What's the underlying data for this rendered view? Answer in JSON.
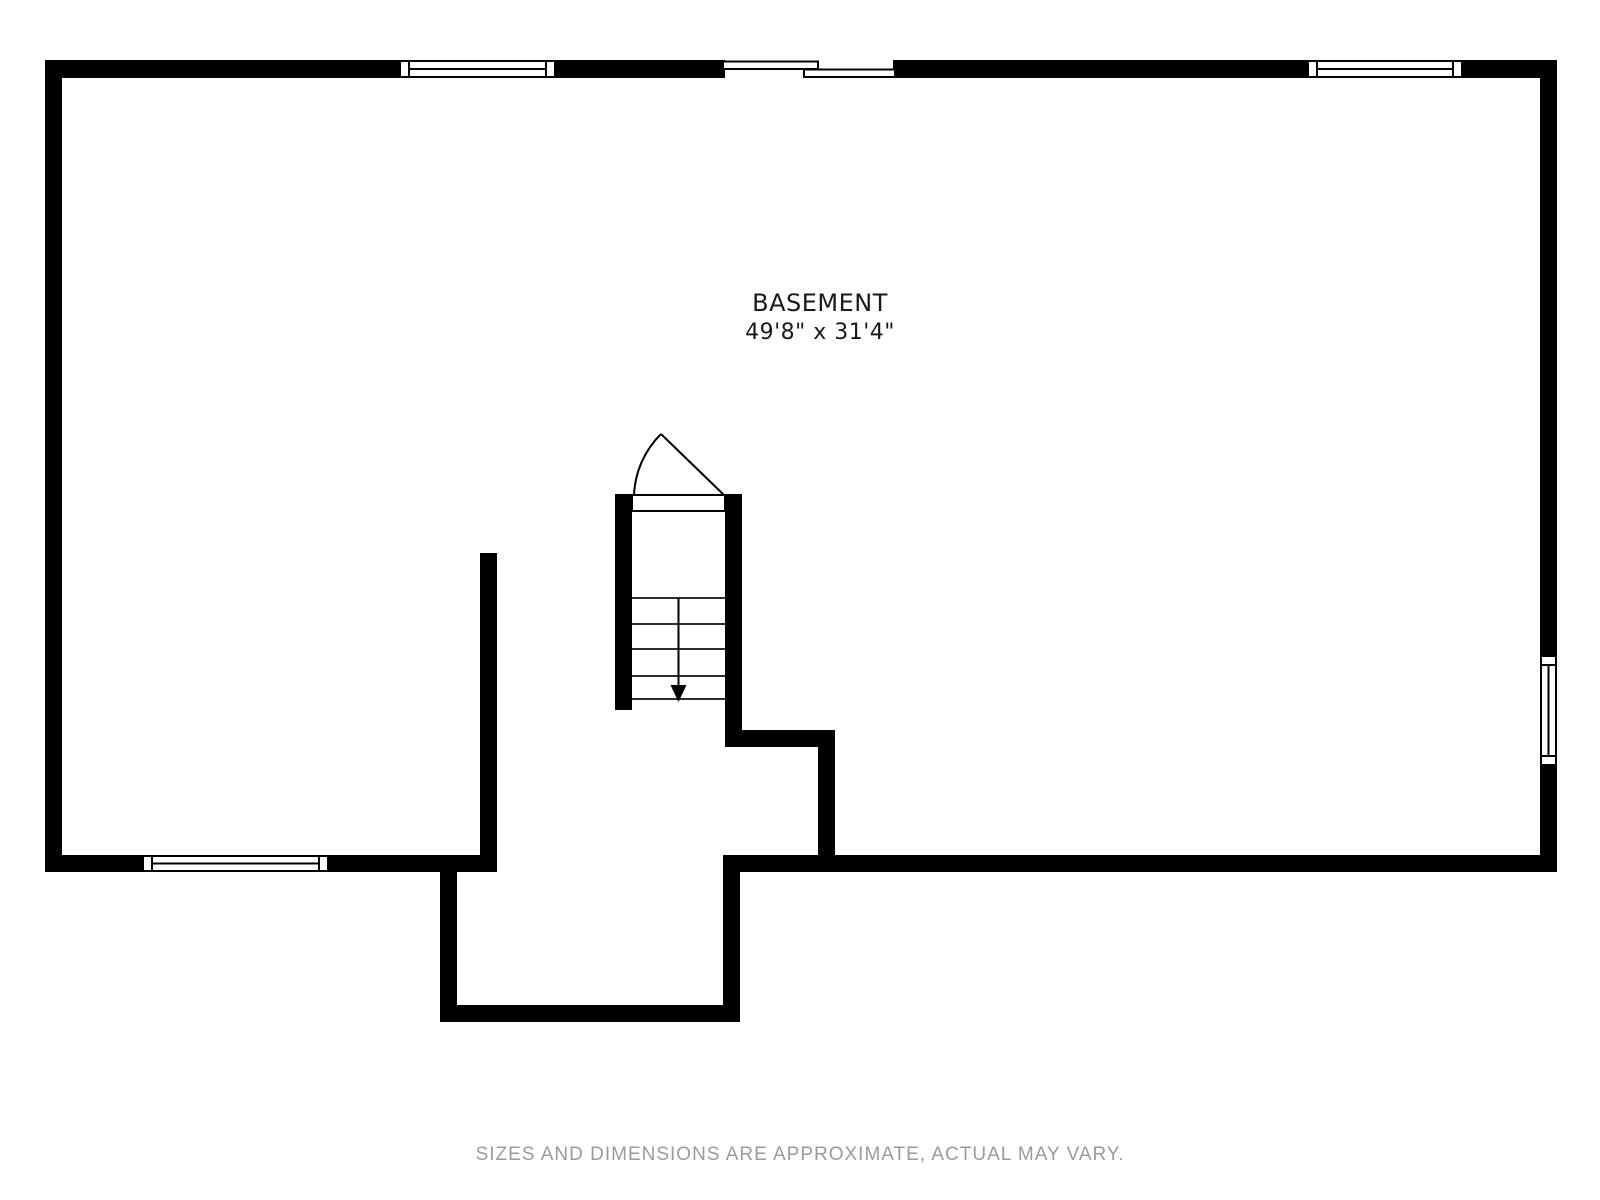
{
  "plan": {
    "room_label": "BASEMENT",
    "room_dimensions": "49'8\" x 31'4\"",
    "elements": {
      "windows": [
        "top-wall-left-window",
        "top-wall-right-window",
        "bottom-wall-left-window",
        "right-wall-window"
      ],
      "doors": [
        "top-wall-sliding-door",
        "stair-swing-door"
      ],
      "stairs": {
        "direction": "down",
        "step_lines_shown": 5
      }
    }
  },
  "footer": {
    "disclaimer": "SIZES AND DIMENSIONS ARE APPROXIMATE, ACTUAL MAY VARY."
  },
  "colors": {
    "wall": "#000000",
    "label_text": "#1a1a1a",
    "step_line": "#2e2e2e",
    "footer_text": "#9b9b9b",
    "background": "#ffffff"
  }
}
